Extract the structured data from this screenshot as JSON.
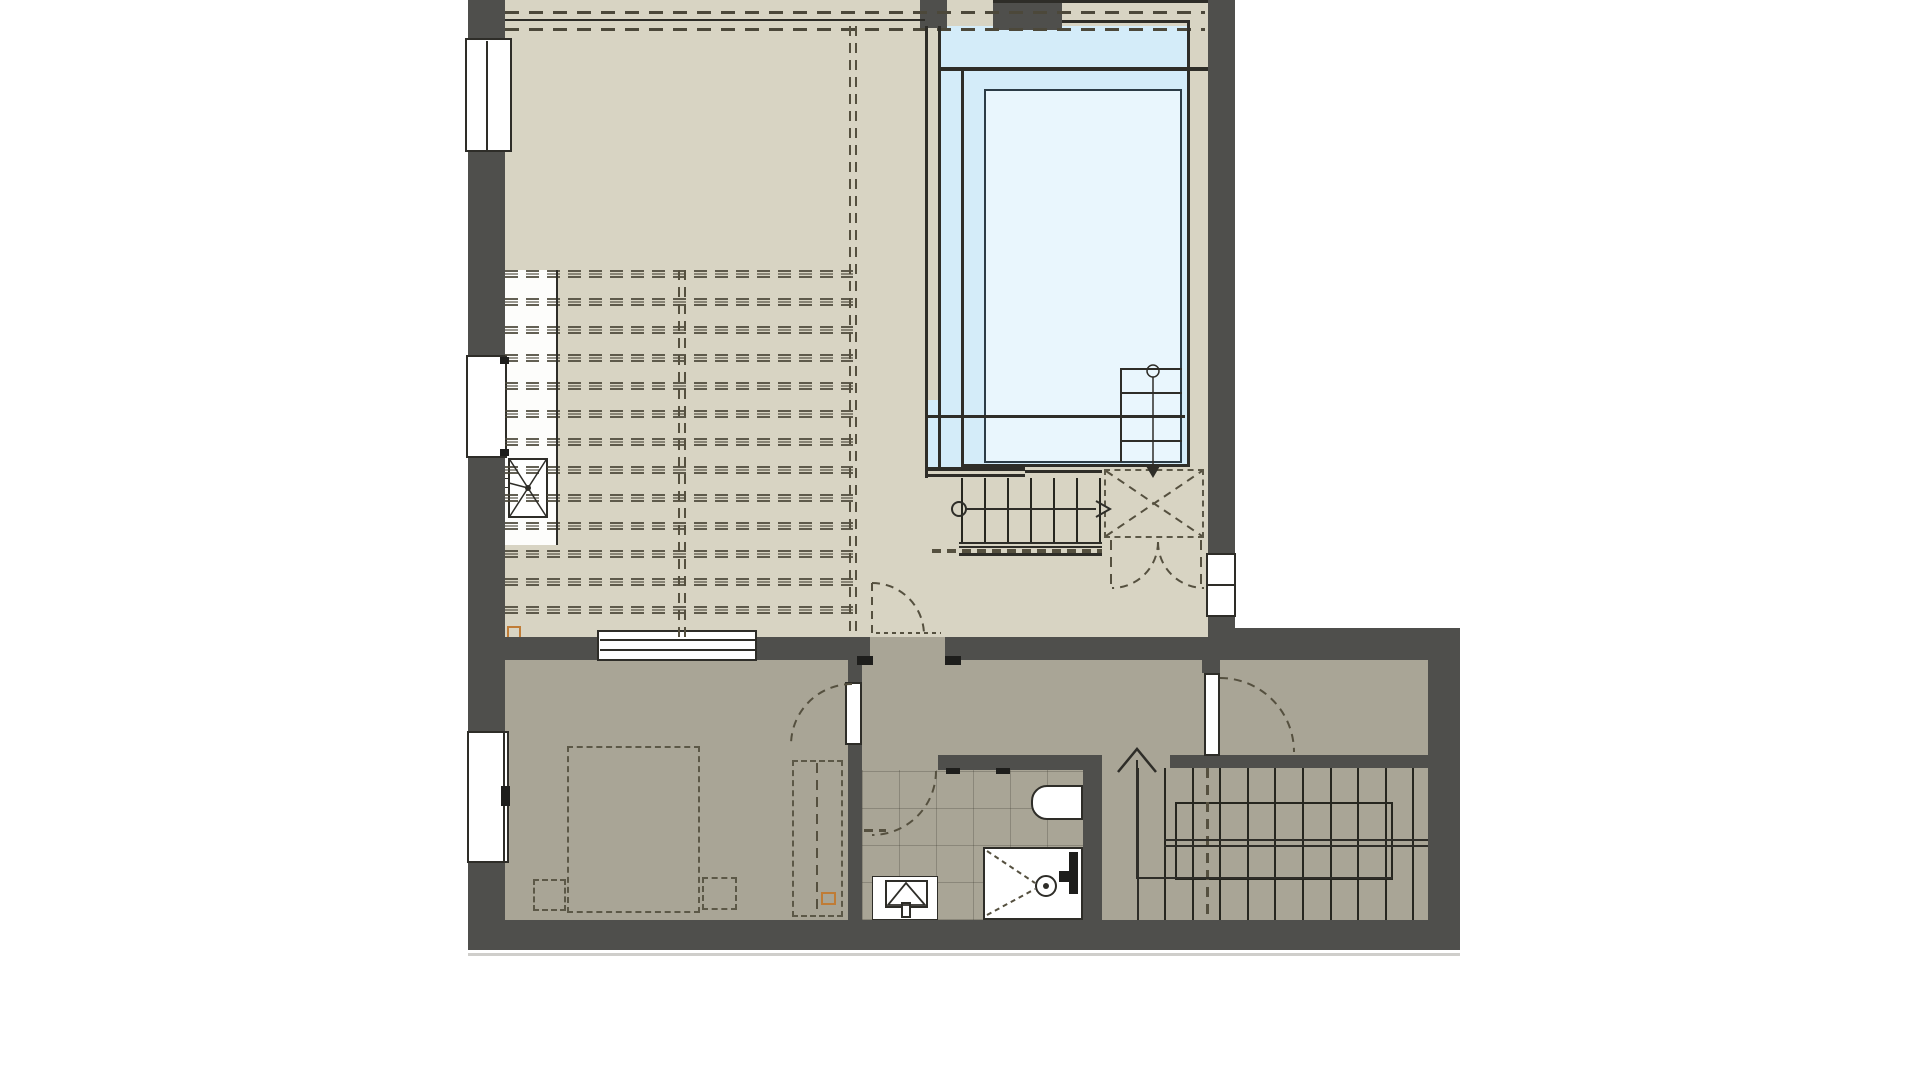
{
  "document": {
    "type": "architectural-floor-plan",
    "visible_text": [],
    "palette": {
      "wall": "#4f4f4c",
      "floor_upper": "#d8d4c3",
      "floor_lower": "#a9a596",
      "pool_deck": "#d4ecf9",
      "pool_basin": "#e9f6fd",
      "line": "#2e2d28",
      "dash": "#55503f",
      "dark": "#1e1e1c",
      "orange": "#c07c36",
      "white": "#ffffff",
      "shadow": "#cfcecb"
    },
    "features": [
      "large-upper-room-with-joist-dashes",
      "swimming-pool-with-steps-and-ladder-arrow",
      "lower-stair-with-walk-arrow",
      "landing-with-x-marking-and-double-door",
      "bedroom-with-dashed-bed-nightstands-closet",
      "bathroom-with-shower-sink-tub",
      "u-shaped-staircase-with-walk-arrow",
      "windows-in-outer-walls"
    ]
  },
  "generated": {
    "dashRows": {
      "x": 505,
      "w": 348,
      "y0": 270,
      "step": 28,
      "count": 13,
      "h": 8
    },
    "topDashRows": [
      {
        "x": 505,
        "y": 11,
        "w": 700,
        "h": 3
      },
      {
        "x": 505,
        "y": 28,
        "w": 700,
        "h": 3
      }
    ],
    "vDashLines": [
      {
        "x": 678,
        "y": 270,
        "w": 2,
        "h": 367
      },
      {
        "x": 684,
        "y": 270,
        "w": 2,
        "h": 367
      },
      {
        "x": 849,
        "y": 26,
        "w": 2,
        "h": 611
      },
      {
        "x": 855,
        "y": 26,
        "w": 2,
        "h": 611
      },
      {
        "x": 1110,
        "y": 540,
        "w": 2,
        "h": 50
      },
      {
        "x": 1200,
        "y": 540,
        "w": 2,
        "h": 50
      },
      {
        "x": 1206,
        "y": 768,
        "w": 3,
        "h": 152
      },
      {
        "x": 816,
        "y": 763,
        "w": 2,
        "h": 150
      }
    ],
    "hDashLines": [
      {
        "x": 932,
        "y": 549,
        "w": 170,
        "h": 4
      },
      {
        "x": 864,
        "y": 829,
        "w": 22,
        "h": 3
      }
    ],
    "lowerStairTreads": {
      "x0": 961,
      "step": 23,
      "count": 7,
      "y": 478,
      "h": 64,
      "w": 2
    },
    "mainStairTreads": {
      "x0": 1164,
      "step": 27.6,
      "count": 10,
      "y": 768,
      "h": 152,
      "w": 2
    },
    "solidLines": [
      {
        "x": 1062,
        "y": 20,
        "w": 128,
        "h": 3,
        "c": "line"
      },
      {
        "x": 941,
        "y": 67,
        "w": 267,
        "h": 4,
        "c": "line"
      },
      {
        "x": 961,
        "y": 67,
        "w": 3,
        "h": 400,
        "c": "line"
      },
      {
        "x": 1187,
        "y": 20,
        "w": 3,
        "h": 447,
        "c": "line"
      },
      {
        "x": 961,
        "y": 464,
        "w": 229,
        "h": 3,
        "c": "line"
      },
      {
        "x": 925,
        "y": 415,
        "w": 260,
        "h": 3,
        "c": "line"
      },
      {
        "x": 1120,
        "y": 368,
        "w": 62,
        "h": 2,
        "c": "line"
      },
      {
        "x": 1120,
        "y": 392,
        "w": 62,
        "h": 2,
        "c": "line"
      },
      {
        "x": 1120,
        "y": 440,
        "w": 62,
        "h": 2,
        "c": "line"
      },
      {
        "x": 1120,
        "y": 368,
        "w": 2,
        "h": 94,
        "c": "line"
      },
      {
        "x": 925,
        "y": 26,
        "w": 3,
        "h": 452,
        "c": "line"
      },
      {
        "x": 938,
        "y": 26,
        "w": 3,
        "h": 441,
        "c": "line"
      },
      {
        "x": 925,
        "y": 467,
        "w": 100,
        "h": 4,
        "c": "line"
      },
      {
        "x": 925,
        "y": 474,
        "w": 100,
        "h": 3,
        "c": "line"
      },
      {
        "x": 1025,
        "y": 470,
        "w": 77,
        "h": 3,
        "c": "line"
      },
      {
        "x": 959,
        "y": 542,
        "w": 143,
        "h": 2,
        "c": "line"
      },
      {
        "x": 959,
        "y": 546,
        "w": 143,
        "h": 2,
        "c": "line"
      },
      {
        "x": 959,
        "y": 553,
        "w": 143,
        "h": 3,
        "c": "line"
      },
      {
        "x": 505,
        "y": 19,
        "w": 420,
        "h": 2,
        "c": "line"
      },
      {
        "x": 556,
        "y": 270,
        "w": 2,
        "h": 275,
        "c": "line"
      },
      {
        "x": 1164,
        "y": 839,
        "w": 264,
        "h": 2,
        "c": "line"
      },
      {
        "x": 1164,
        "y": 845,
        "w": 264,
        "h": 2,
        "c": "line"
      },
      {
        "x": 1137,
        "y": 768,
        "w": 2,
        "h": 152,
        "c": "line"
      },
      {
        "x": 993,
        "y": 0,
        "w": 215,
        "h": 3,
        "c": "line"
      },
      {
        "x": 857,
        "y": 656,
        "w": 16,
        "h": 9,
        "c": "dark"
      },
      {
        "x": 945,
        "y": 656,
        "w": 16,
        "h": 9,
        "c": "dark"
      },
      {
        "x": 946,
        "y": 768,
        "w": 14,
        "h": 6,
        "c": "dark"
      },
      {
        "x": 996,
        "y": 768,
        "w": 14,
        "h": 6,
        "c": "dark"
      },
      {
        "x": 600,
        "y": 639,
        "w": 155,
        "h": 2,
        "c": "line"
      },
      {
        "x": 600,
        "y": 649,
        "w": 155,
        "h": 2,
        "c": "line"
      },
      {
        "x": 486,
        "y": 41,
        "w": 2,
        "h": 109,
        "c": "line"
      },
      {
        "x": 503,
        "y": 733,
        "w": 2,
        "h": 128,
        "c": "line"
      },
      {
        "x": 501,
        "y": 786,
        "w": 9,
        "h": 20,
        "c": "dark"
      },
      {
        "x": 500,
        "y": 357,
        "w": 9,
        "h": 7,
        "c": "dark"
      },
      {
        "x": 500,
        "y": 449,
        "w": 9,
        "h": 7,
        "c": "dark"
      },
      {
        "x": 1069,
        "y": 852,
        "w": 9,
        "h": 42,
        "c": "dark"
      },
      {
        "x": 1059,
        "y": 871,
        "w": 10,
        "h": 11,
        "c": "dark"
      }
    ]
  }
}
